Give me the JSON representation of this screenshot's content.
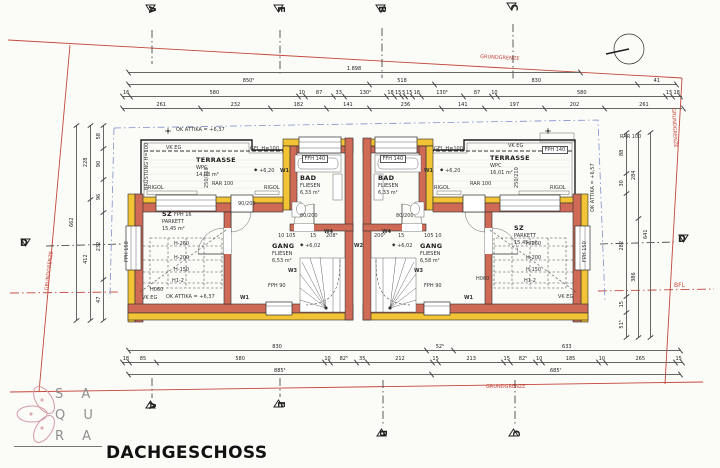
{
  "title": "DACHGESCHOSS",
  "logo": {
    "line1": "S A",
    "line2": "Q U",
    "line3": "R A"
  },
  "colors": {
    "wall_red": "#cf6a57",
    "insulation_yellow": "#f2c335",
    "boundary_red": "#c4473b",
    "roof_blue": "#7d90c9"
  },
  "boundary": {
    "grundgrenze": "GRUNDGRENZE",
    "bfl": "BFL"
  },
  "markers": {
    "a": "A",
    "e": "E",
    "b": "B",
    "c": "C",
    "d": "D"
  },
  "icons": {
    "level_marker_glyph": "◆",
    "north": "north-circle"
  },
  "rooms": {
    "terrasse_l": {
      "name": "TERRASSE",
      "finish": "WPC",
      "area": "14,06 m²"
    },
    "terrasse_r": {
      "name": "TERRASSE",
      "finish": "WPC",
      "area": "16,01 m²"
    },
    "bad_l": {
      "name": "BAD",
      "finish": "FLIESEN",
      "area": "6,33 m²"
    },
    "bad_r": {
      "name": "BAD",
      "finish": "FLIESEN",
      "area": "6,33 m²"
    },
    "sz_l": {
      "name": "SZ",
      "finish": "PARKETT",
      "area": "15,45 m²"
    },
    "sz_r": {
      "name": "SZ",
      "finish": "PARKETT",
      "area": "15,45 m²"
    },
    "gang_l": {
      "name": "GANG",
      "finish": "FLIESEN",
      "area": "6,53 m²"
    },
    "gang_r": {
      "name": "GANG",
      "finish": "FLIESEN",
      "area": "6,58 m²"
    }
  },
  "windows": {
    "ffh140": "FFH 140",
    "fph140": "FPH 140",
    "fph150": "FPH 150",
    "fph90": "FPH 90",
    "fph16": "FPH 16",
    "rar100": "RAR 100",
    "rigol": "RIGOL"
  },
  "levels": {
    "ok_attika": "OK ATTIKA = +6,37",
    "ok_attika_r": "OK ATTIKA = +6,57",
    "vk_eg": "VK EG",
    "gel": "GEL H=100",
    "bruestung": "BRÜSTUNG H=100",
    "p620": "+6,20",
    "p602": "+6,02"
  },
  "wmarks": {
    "w1": "W1",
    "w2": "W2",
    "w3": "W3",
    "w4": "W4"
  },
  "heights": {
    "h260": "H-260",
    "h200": "H-200",
    "h150": "H-150",
    "h12": "H1-2",
    "h060": "H060"
  },
  "door_sizes": {
    "d80": "80/200",
    "d90": "90/200",
    "d250": "250/210"
  },
  "mini_dims": {
    "l": "10  105",
    "r": "105  10",
    "a": "15",
    "b": "208⁵",
    "c": "200⁵",
    "d": "15"
  },
  "chains": {
    "top1": {
      "x": 128,
      "y": 64,
      "w": 452,
      "segs": [
        {
          "v": "1.898",
          "f": 1
        }
      ]
    },
    "top2": {
      "x": 128,
      "y": 76,
      "w": 548,
      "segs": [
        {
          "v": "850⁵",
          "f": 0.44
        },
        {
          "v": "518",
          "f": 0.12
        },
        {
          "v": "830",
          "f": 0.37
        },
        {
          "v": "41",
          "f": 0.07
        }
      ]
    },
    "top3": {
      "x": 122,
      "y": 88,
      "w": 560,
      "segs": [
        {
          "v": "16",
          "f": 0.015
        },
        {
          "v": "580",
          "f": 0.3
        },
        {
          "v": "10",
          "f": 0.012
        },
        {
          "v": "87",
          "f": 0.05
        },
        {
          "v": "33",
          "f": 0.02
        },
        {
          "v": "130⁵",
          "f": 0.075
        },
        {
          "v": "18",
          "f": 0.015
        },
        {
          "v": "15",
          "f": 0.012
        },
        {
          "v": "5",
          "f": 0.008
        },
        {
          "v": "15",
          "f": 0.012
        },
        {
          "v": "18",
          "f": 0.015
        },
        {
          "v": "130⁵",
          "f": 0.075
        },
        {
          "v": "87",
          "f": 0.05
        },
        {
          "v": "10",
          "f": 0.012
        },
        {
          "v": "580",
          "f": 0.3
        },
        {
          "v": "15",
          "f": 0.012
        },
        {
          "v": "18",
          "f": 0.015
        }
      ]
    },
    "top4": {
      "x": 122,
      "y": 100,
      "w": 560,
      "segs": [
        {
          "v": "261",
          "f": 0.14
        },
        {
          "v": "232",
          "f": 0.125
        },
        {
          "v": "182",
          "f": 0.1
        },
        {
          "v": "141",
          "f": 0.077
        },
        {
          "v": "236",
          "f": 0.128
        },
        {
          "v": "141",
          "f": 0.077
        },
        {
          "v": "197",
          "f": 0.107
        },
        {
          "v": "202",
          "f": 0.108
        },
        {
          "v": "261",
          "f": 0.14
        }
      ]
    },
    "bot1": {
      "x": 128,
      "y": 342,
      "w": 552,
      "segs": [
        {
          "v": "830",
          "f": 0.54
        },
        {
          "v": "52⁵",
          "f": 0.05
        },
        {
          "v": "633",
          "f": 0.41
        }
      ]
    },
    "bot2": {
      "x": 122,
      "y": 354,
      "w": 560,
      "segs": [
        {
          "v": "18",
          "f": 0.014
        },
        {
          "v": "85",
          "f": 0.047
        },
        {
          "v": "580",
          "f": 0.3
        },
        {
          "v": "10",
          "f": 0.012
        },
        {
          "v": "82⁵",
          "f": 0.046
        },
        {
          "v": "35",
          "f": 0.02
        },
        {
          "v": "212",
          "f": 0.115
        },
        {
          "v": "15",
          "f": 0.012
        },
        {
          "v": "213",
          "f": 0.115
        },
        {
          "v": "15",
          "f": 0.012
        },
        {
          "v": "82⁵",
          "f": 0.046
        },
        {
          "v": "10",
          "f": 0.012
        },
        {
          "v": "185",
          "f": 0.1
        },
        {
          "v": "10",
          "f": 0.012
        },
        {
          "v": "265",
          "f": 0.125
        },
        {
          "v": "15",
          "f": 0.012
        }
      ]
    },
    "bot3": {
      "x": 128,
      "y": 366,
      "w": 552,
      "segs": [
        {
          "v": "885⁵",
          "f": 0.55
        },
        {
          "v": "685⁷",
          "f": 0.45
        }
      ]
    },
    "left1": {
      "x": 68,
      "y": 125,
      "h": 195,
      "segs": [
        {
          "v": "662",
          "f": 1
        }
      ]
    },
    "left2": {
      "x": 82,
      "y": 125,
      "h": 195,
      "segs": [
        {
          "v": "228",
          "f": 0.38
        },
        {
          "v": "412",
          "f": 0.62
        }
      ]
    },
    "left3": {
      "x": 95,
      "y": 125,
      "h": 195,
      "segs": [
        {
          "v": "58",
          "f": 0.12
        },
        {
          "v": "90",
          "f": 0.16
        },
        {
          "v": "96",
          "f": 0.17
        },
        {
          "v": "232",
          "f": 0.34
        },
        {
          "v": "47",
          "f": 0.21
        }
      ]
    },
    "right3": {
      "x": 618,
      "y": 132,
      "h": 205,
      "segs": [
        {
          "v": "88",
          "f": 0.2
        },
        {
          "v": "30",
          "f": 0.1
        },
        {
          "v": "282",
          "f": 0.5
        },
        {
          "v": "15",
          "f": 0.08
        },
        {
          "v": "51⁵",
          "f": 0.12
        }
      ]
    },
    "right2": {
      "x": 630,
      "y": 132,
      "h": 205,
      "segs": [
        {
          "v": "284",
          "f": 0.42
        },
        {
          "v": "386",
          "f": 0.58
        }
      ]
    },
    "right1": {
      "x": 642,
      "y": 132,
      "h": 205,
      "segs": [
        {
          "v": "641",
          "f": 1
        }
      ]
    }
  }
}
